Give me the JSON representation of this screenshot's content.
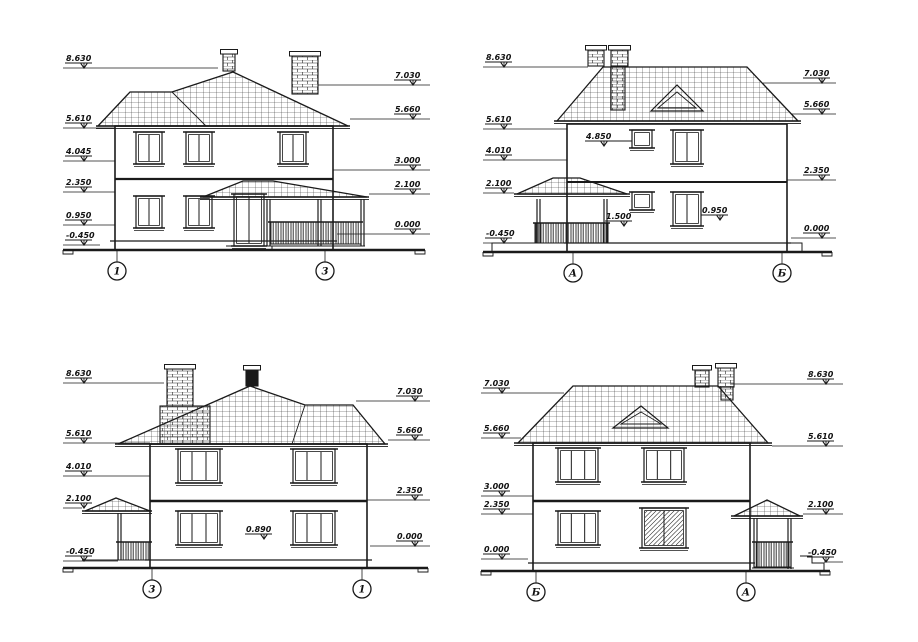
{
  "sheet": {
    "background": "#ffffff",
    "line_color": "#1a1a1a",
    "drawing_type": "house facade elevations"
  },
  "views": [
    {
      "id": "elevation-1-3",
      "axes": [
        "1",
        "3"
      ],
      "levels_left": [
        "8.630",
        "5.610",
        "4.045",
        "2.350",
        "0.950",
        "-0.450"
      ],
      "levels_right": [
        "7.030",
        "5.660",
        "3.000",
        "2.100",
        "0.000"
      ],
      "levels_inner": []
    },
    {
      "id": "elevation-A-B",
      "axes": [
        "А",
        "Б"
      ],
      "levels_left": [
        "8.630",
        "5.610",
        "4.010",
        "2.100",
        "-0.450"
      ],
      "levels_right": [
        "7.030",
        "5.660",
        "2.350",
        "0.000"
      ],
      "levels_inner": [
        "4.850",
        "1.500",
        "0.950"
      ]
    },
    {
      "id": "elevation-3-1",
      "axes": [
        "3",
        "1"
      ],
      "levels_left": [
        "8.630",
        "5.610",
        "4.010",
        "2.100",
        "-0.450"
      ],
      "levels_right": [
        "7.030",
        "5.660",
        "2.350",
        "0.000"
      ],
      "levels_inner": [
        "0.890"
      ]
    },
    {
      "id": "elevation-B-A",
      "axes": [
        "Б",
        "А"
      ],
      "levels_left": [
        "7.030",
        "5.660",
        "3.000",
        "2.350",
        "0.000"
      ],
      "levels_right": [
        "8.630",
        "5.610",
        "2.100",
        "-0.450"
      ],
      "levels_inner": []
    }
  ]
}
